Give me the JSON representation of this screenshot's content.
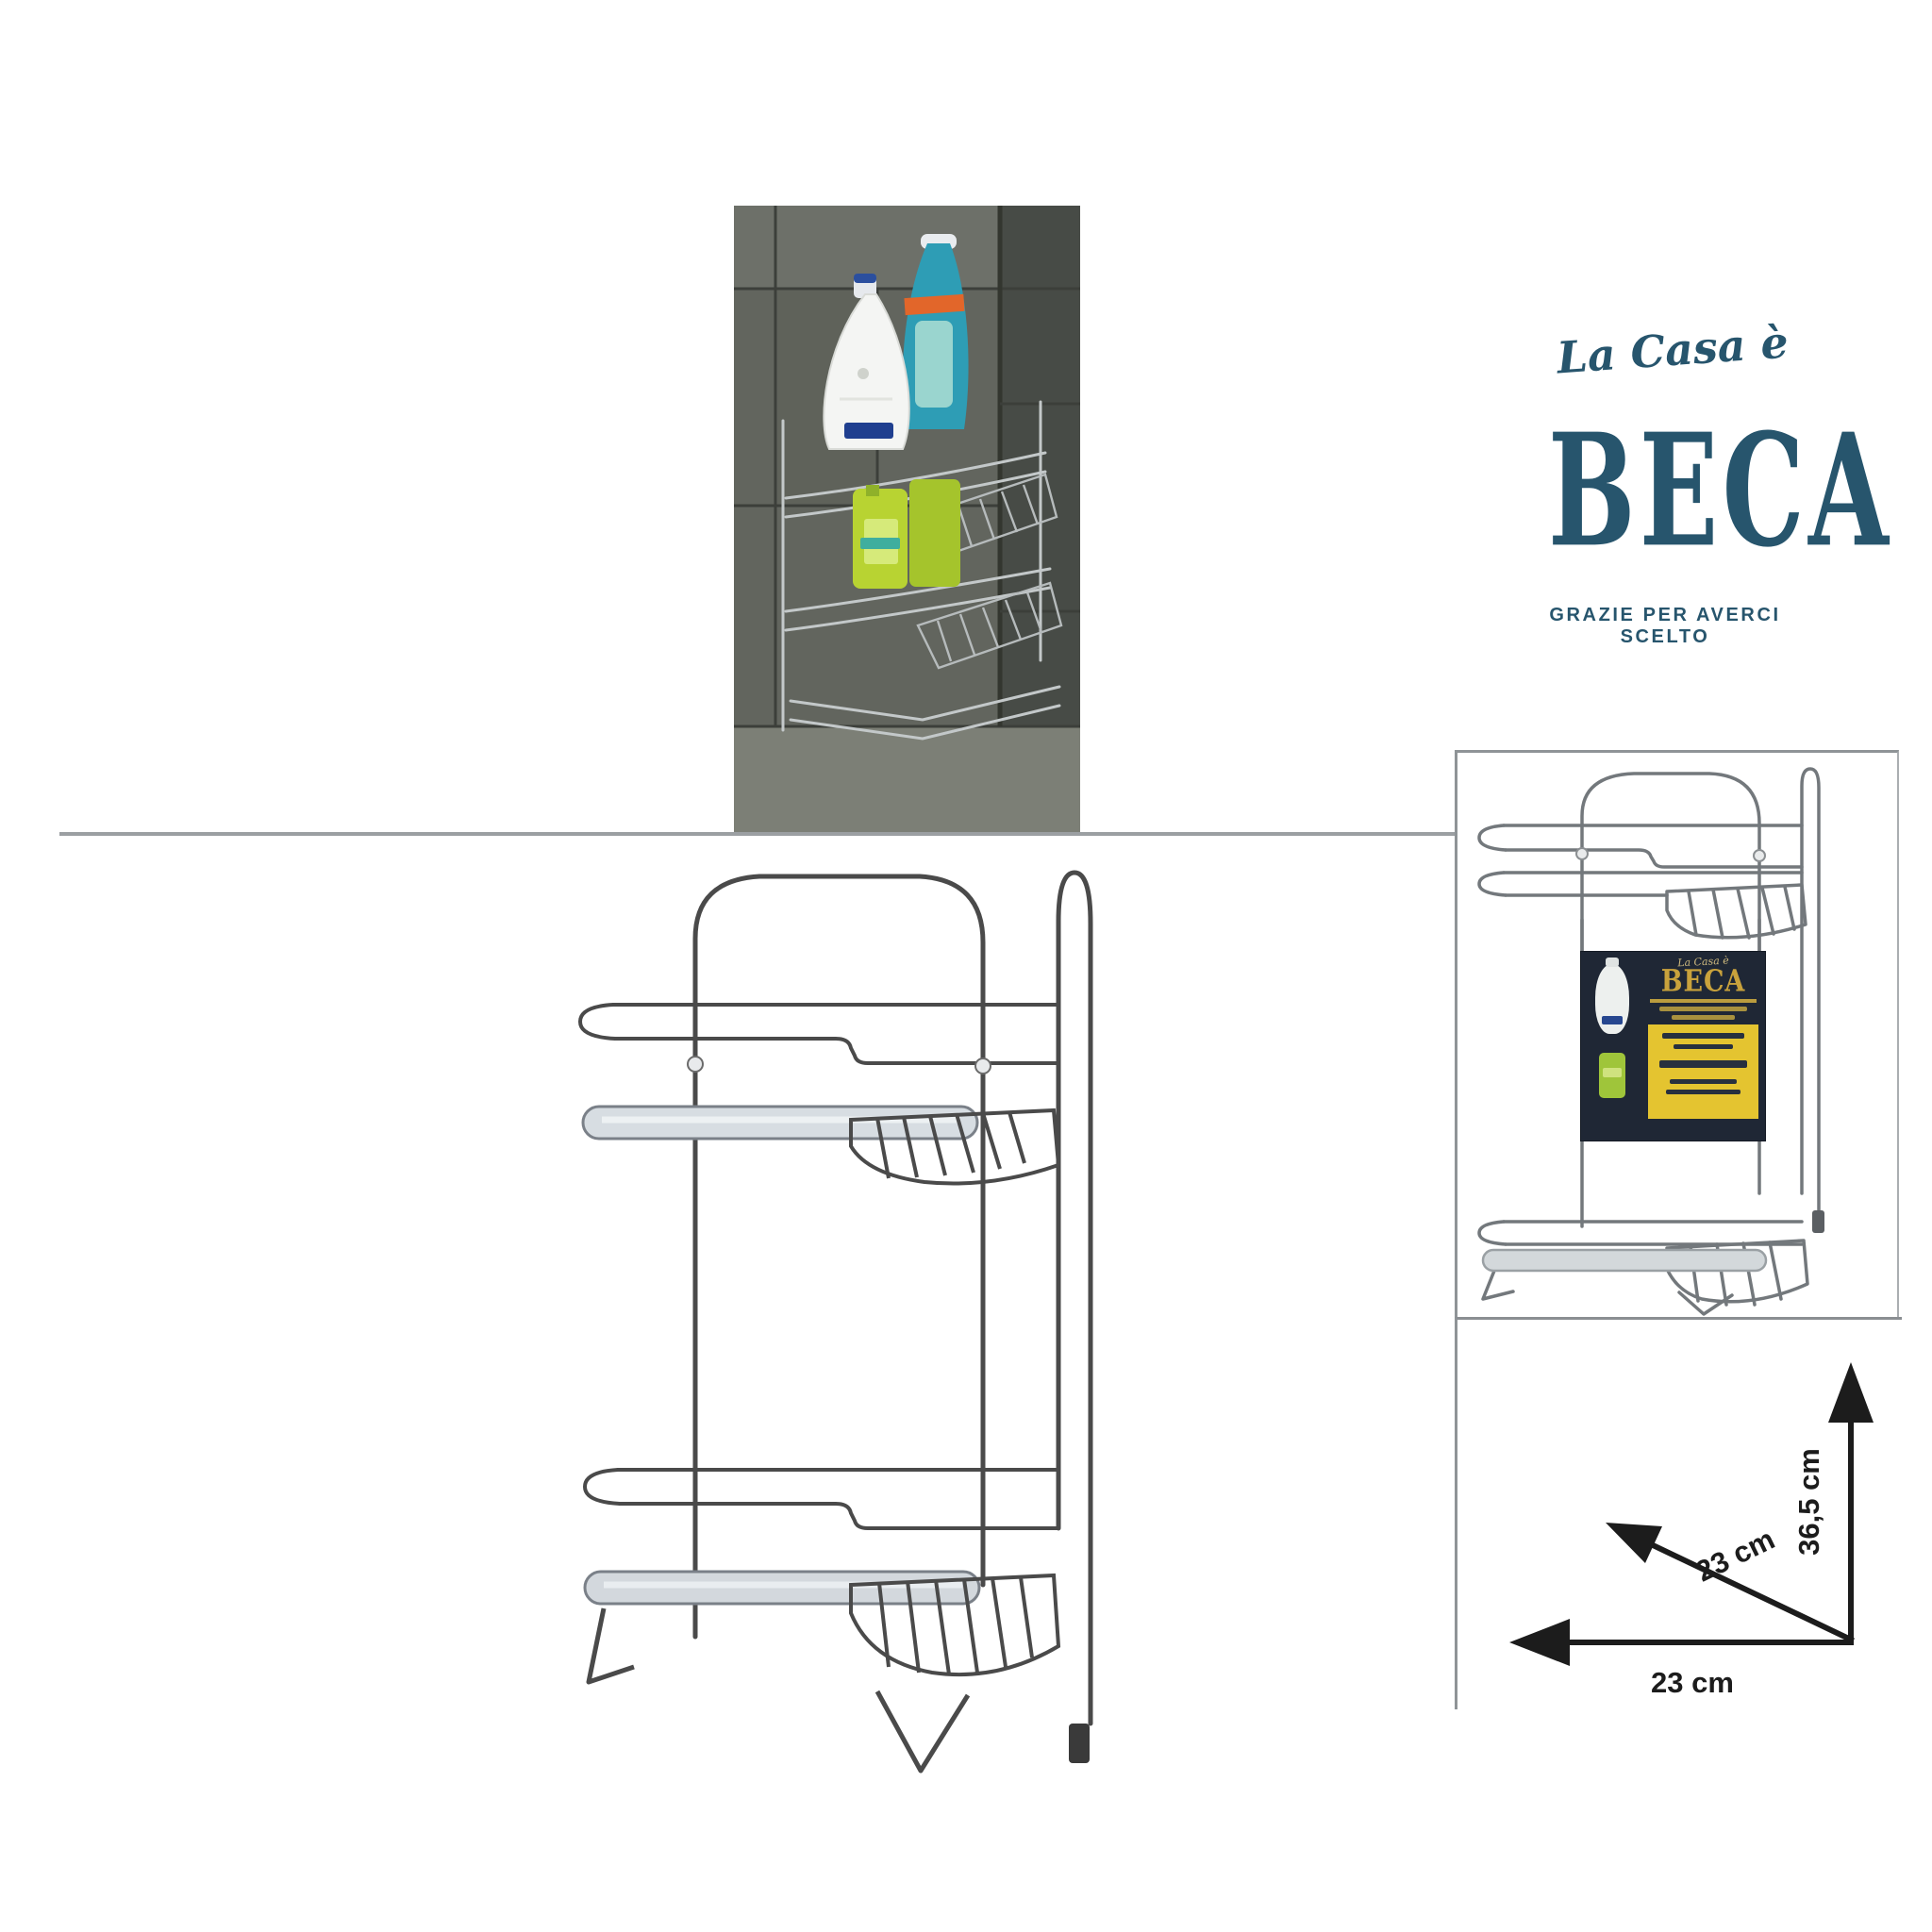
{
  "brand": {
    "script": "La Casa è",
    "name": "BECA",
    "tagline": "GRAZIE PER AVERCI SCELTO",
    "color": "#27556d"
  },
  "package_card": {
    "script": "La Casa è",
    "name": "BECA",
    "colors": {
      "background": "#1f2735",
      "gold": "#c9a23c",
      "panel_yellow": "#e4c430"
    }
  },
  "dimensions": {
    "height": "36,5 cm",
    "depth": "23 cm",
    "width": "23 cm"
  },
  "colors": {
    "divider_grey": "#9b9fa2",
    "drawing_line": "#4a4a4a",
    "arrow_black": "#1c1c1c"
  }
}
